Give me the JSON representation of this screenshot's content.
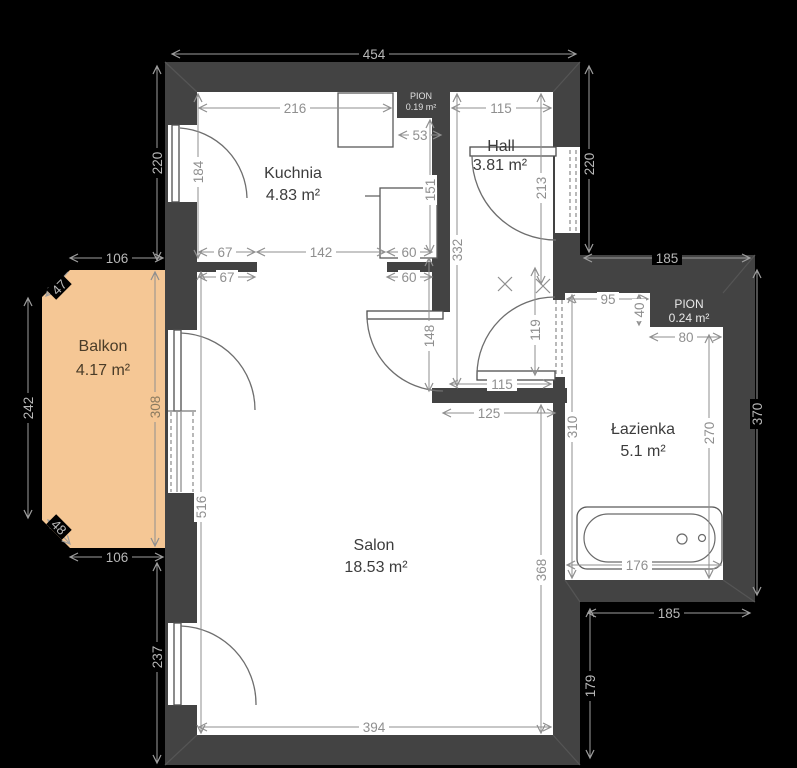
{
  "colors": {
    "background": "#000000",
    "wall": "#434343",
    "room_fill": "#ffffff",
    "balcony_fill": "#f5c795",
    "dim_text_dark_bg": "#b8b8b8",
    "dim_text_light_bg": "#8f8f8f"
  },
  "rooms": {
    "kuchnia": {
      "name": "Kuchnia",
      "area": "4.83 m²"
    },
    "hall": {
      "name": "Hall",
      "area": "3.81 m²"
    },
    "balkon": {
      "name": "Balkon",
      "area": "4.17 m²"
    },
    "salon": {
      "name": "Salon",
      "area": "18.53 m²"
    },
    "lazienka": {
      "name": "Łazienka",
      "area": "5.1 m²"
    },
    "pion": {
      "name": "PION",
      "area": "0.24 m²"
    },
    "pion_top": {
      "name": "PION",
      "area": "0.19 m²"
    }
  },
  "dims": {
    "total_width": "454",
    "left_top": "220",
    "right_top": "220",
    "kitchen_width": "216",
    "hall_width": "115",
    "pion_gap": "53",
    "kitchen_door": "184",
    "fridge": "151",
    "hall_height": "332",
    "entry": "213",
    "balcony_top": "106",
    "balcony_bevel_top": "47",
    "balcony_left": "242",
    "balcony_right": "308",
    "balcony_bevel_bottom": "48",
    "balcony_bottom": "106",
    "k_left": "67",
    "k_pass": "142",
    "k_right": "60",
    "k_left2": "67",
    "k_right2": "60",
    "salon_door": "148",
    "hall_door_h": "119",
    "hall_door_w": "115",
    "corridor": "125",
    "bath_top": "95",
    "pion_h": "40",
    "pion_w": "80",
    "bath_section_top": "185",
    "bath_right_outer": "370",
    "bath_left": "310",
    "bath_right_inner": "270",
    "tub": "176",
    "bath_section_bottom": "185",
    "right_bottom": "179",
    "salon_right": "368",
    "salon_bottom": "394",
    "left_bottom": "237",
    "salon_left": "516"
  }
}
